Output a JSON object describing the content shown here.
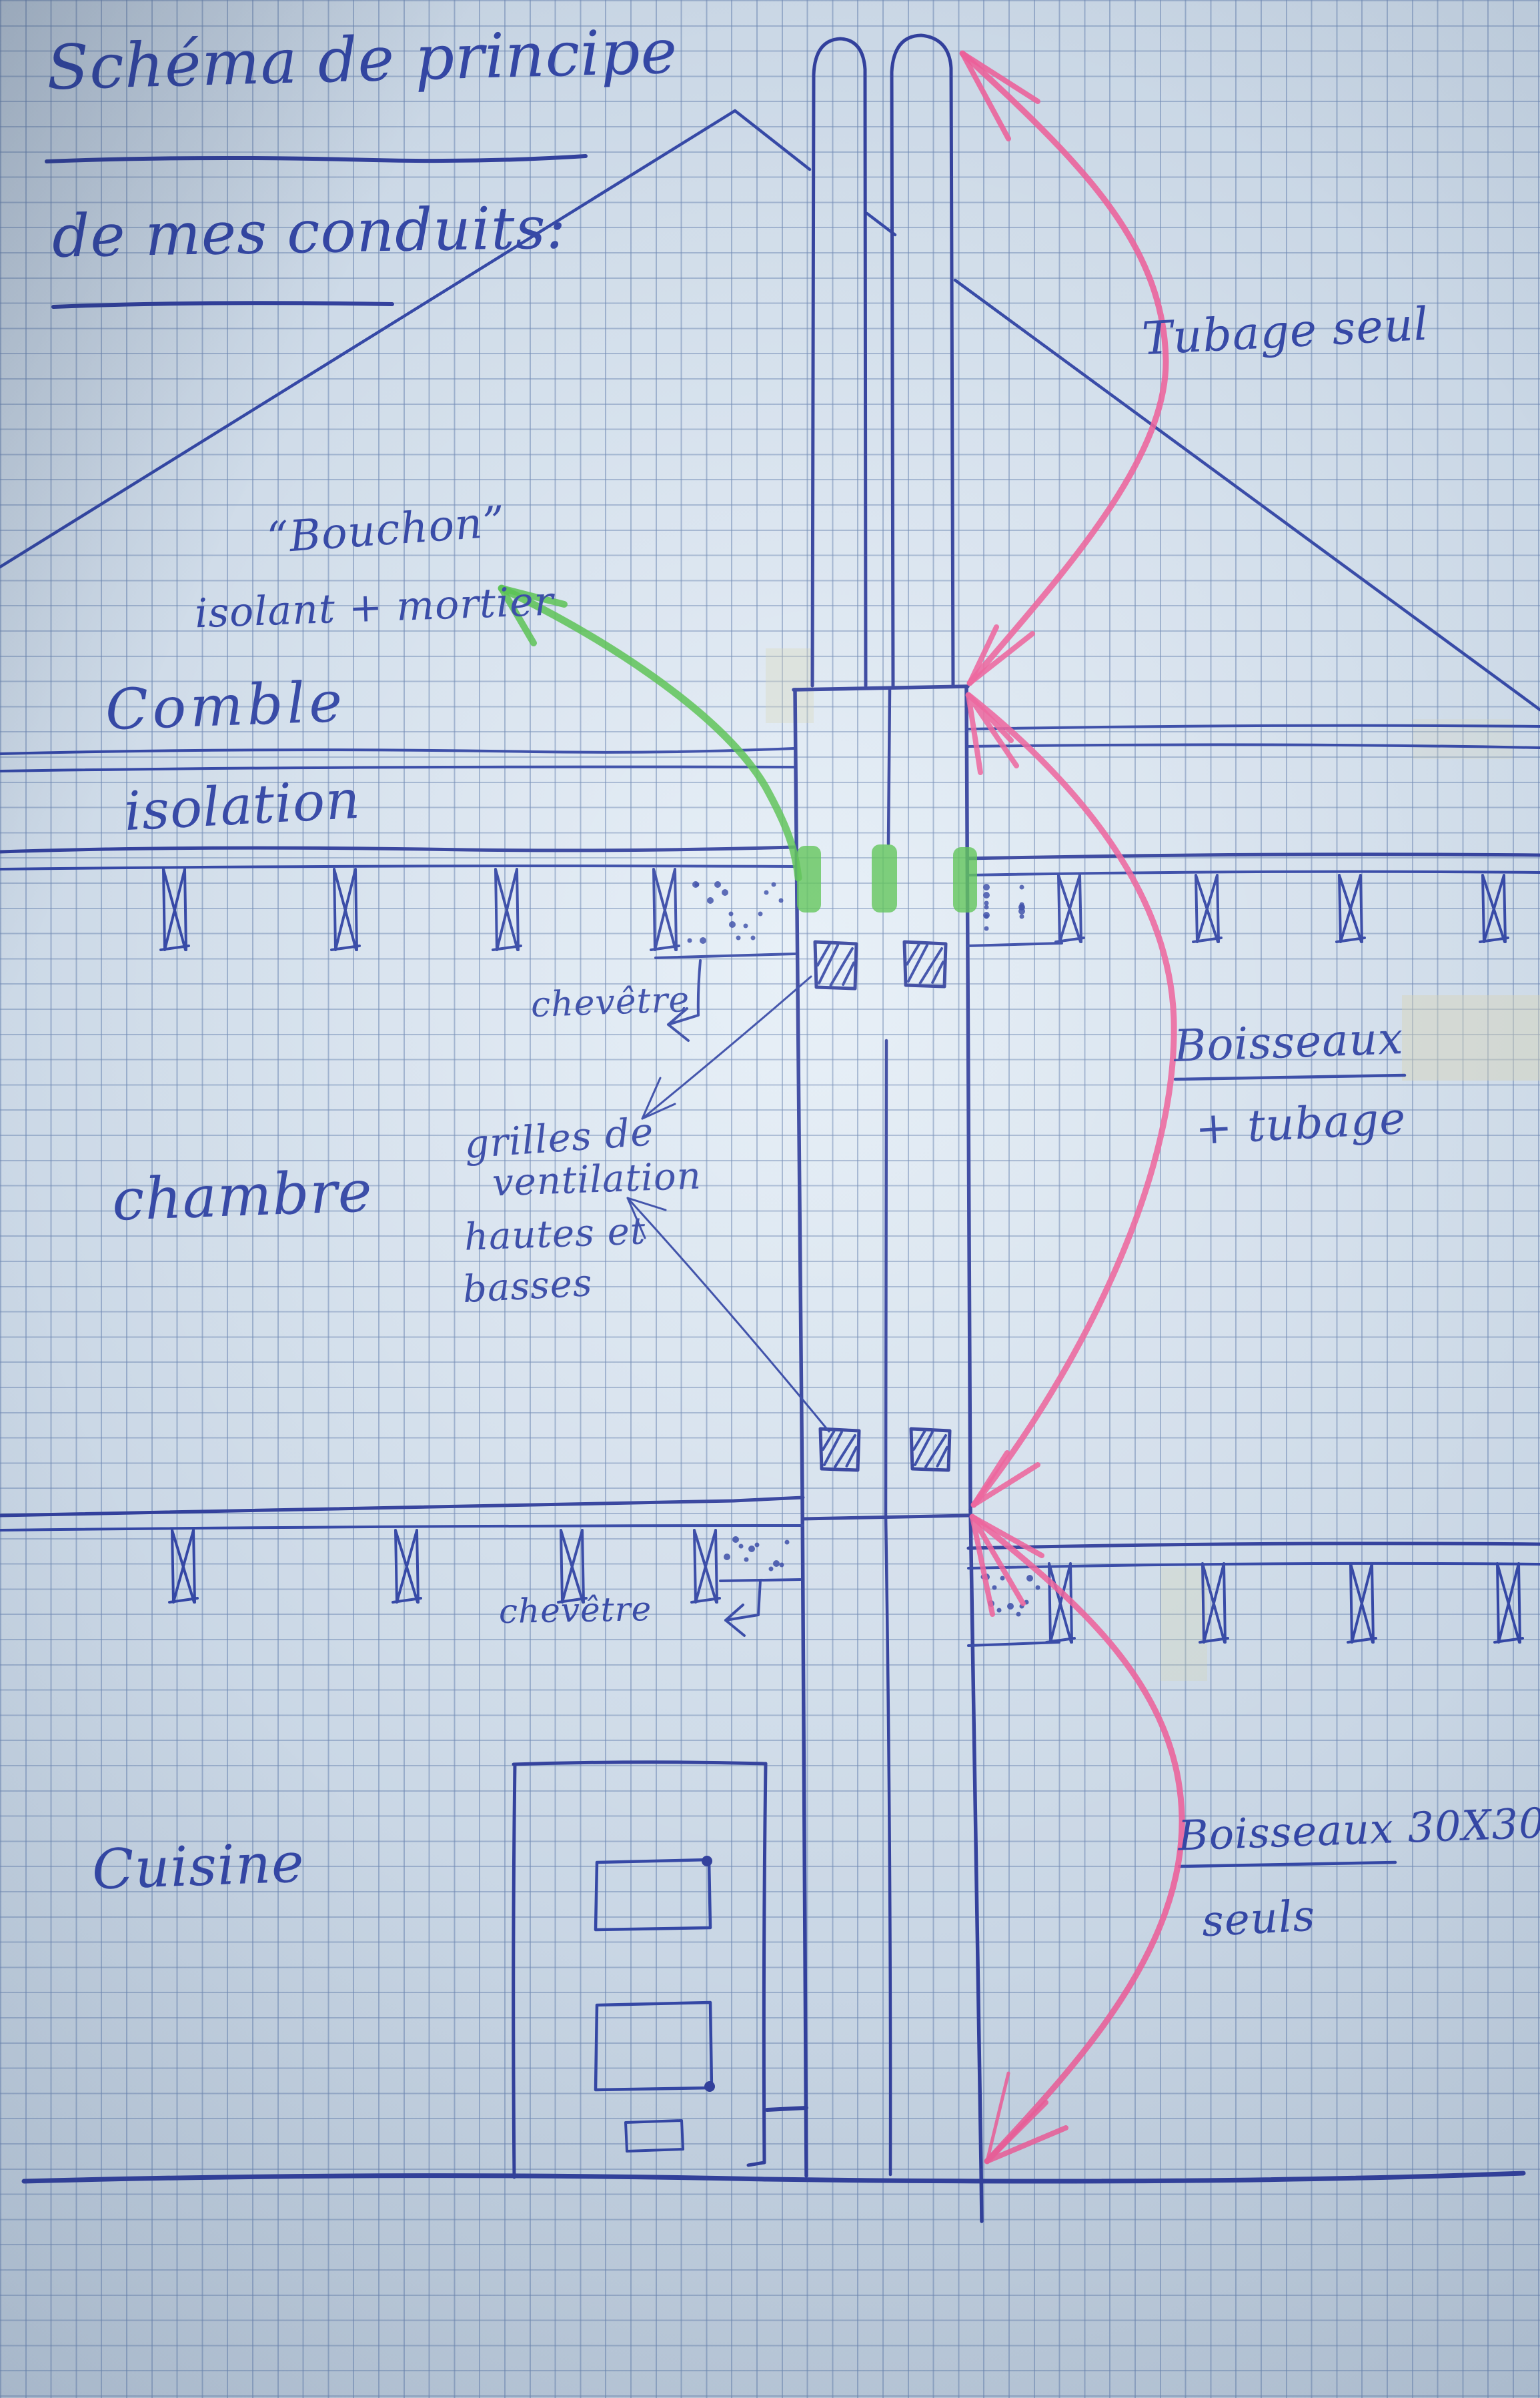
{
  "title": {
    "line1": "Schéma de principe",
    "line2": "de mes conduits:"
  },
  "labels": {
    "tubage_seul": "Tubage seul",
    "bouchon_line1": "“Bouchon”",
    "bouchon_line2": "isolant + mortier",
    "comble": "Comble",
    "isolation": "isolation",
    "chevetre1": "chevêtre",
    "grilles_line1": "grilles de",
    "grilles_line2": "ventilation",
    "grilles_line3": "hautes et",
    "grilles_line4": "basses",
    "chambre": "chambre",
    "boisseaux": "Boisseaux",
    "plus_tubage": "+ tubage",
    "chevetre2": "chevêtre",
    "cuisine": "Cuisine",
    "boisseaux_3030": "Boisseaux 30X30",
    "seuls": "seuls"
  },
  "colors": {
    "ink": "#3447a5",
    "pink": "#ec5f98",
    "green": "#55c04e",
    "paper": "#c9d6e4",
    "grid": "#6d87b2"
  }
}
